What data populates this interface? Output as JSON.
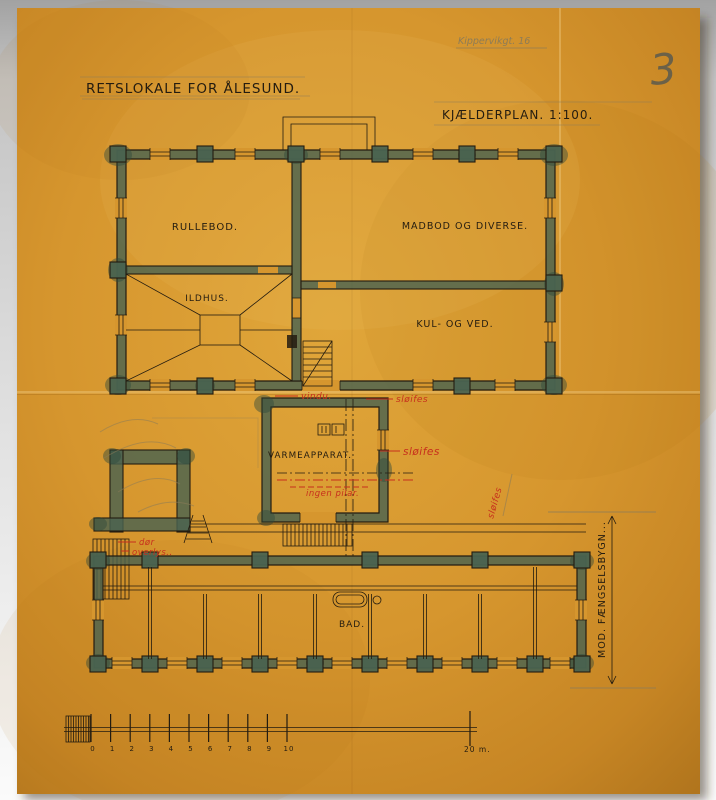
{
  "sheet": {
    "archive_note": "Kippervikgt. 16",
    "sheet_number": "3",
    "title": "RETSLOKALE FOR ÅLESUND.",
    "plan_label": "KJÆLDERPLAN. 1:100."
  },
  "rooms": {
    "rullebod": "RULLEBOD.",
    "madbod": "MADBOD OG DIVERSE.",
    "ildhus": "ILDHUS.",
    "kul_ved": "KUL- OG VED.",
    "varmeapparat": "VARMEAPPARAT.",
    "bad": "BAD."
  },
  "annotations_red": {
    "vindu": "vindu.",
    "sloifes_window": "sløifes",
    "sloifes_heater": "sløifes",
    "sloifes_corridor": "sløifes",
    "ingen_pilar": "ingen pilar.",
    "dor": "dør",
    "overlys": "overlys.."
  },
  "dimension": {
    "label": "MOD. FÆNGSELSBYGN..."
  },
  "scale_bar": {
    "ticks": [
      "0",
      "1",
      "2",
      "3",
      "4",
      "5",
      "6",
      "7",
      "8",
      "9",
      "10"
    ],
    "end_label": "20 m."
  },
  "colors": {
    "paper": "#d6962e",
    "ink": "#241c10",
    "red": "#c72f1d",
    "wall": "#4a6350",
    "wall_dark": "#2f4a3c",
    "pencil": "#8d7c57",
    "pencil_dark": "#6b6148"
  }
}
